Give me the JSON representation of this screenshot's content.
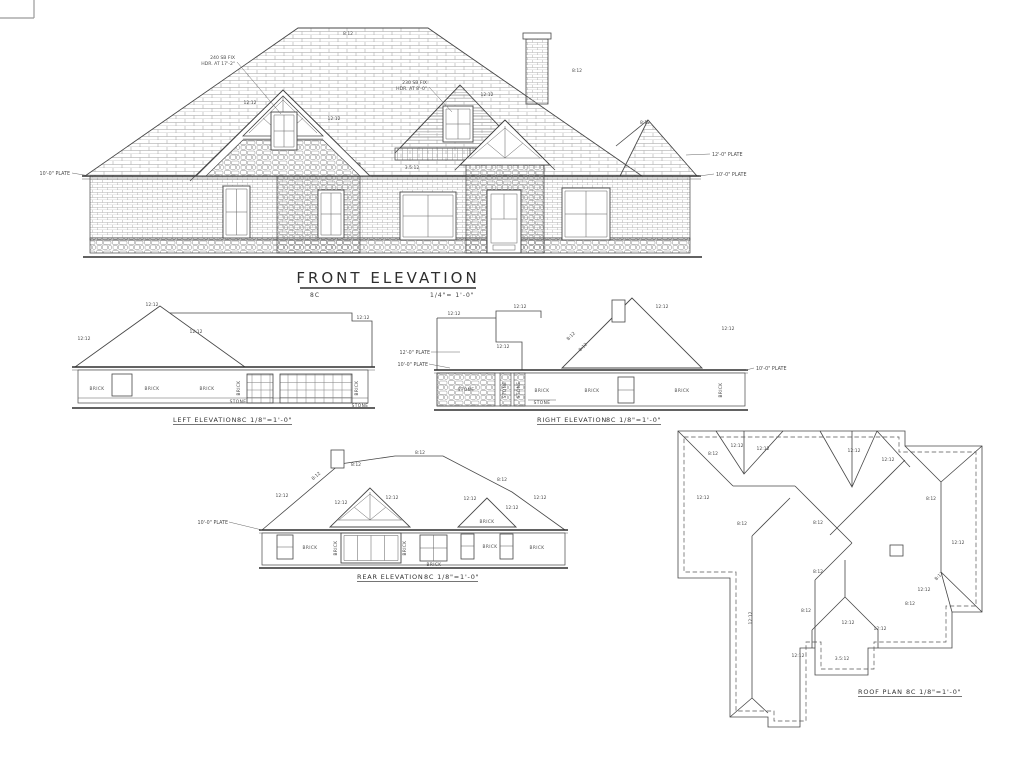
{
  "labels": {
    "brick": "BRICK",
    "stone": "STONE"
  },
  "pitches": {
    "p8": "8:12",
    "p12": "12:12",
    "p35": "3.5:12"
  },
  "plates": {
    "p10": "10'-0\" PLATE",
    "p12": "12'-0\" PLATE"
  },
  "front": {
    "title": "FRONT ELEVATION",
    "tag": "8C",
    "scale": "1/4\"= 1'-0\"",
    "note1_l1": "240 SB FIX",
    "note1_l2": "HDR. AT 17'-2\"",
    "note2_l1": "230 SB FIX",
    "note2_l2": "HDR. AT 8'-0\""
  },
  "left": {
    "title": "LEFT ELEVATION",
    "scale": "8C 1/8\"=1'-0\""
  },
  "right": {
    "title": "RIGHT ELEVATION",
    "scale": "8C 1/8\"=1'-0\""
  },
  "rear": {
    "title": "REAR ELEVATION",
    "scale": "8C 1/8\"=1'-0\""
  },
  "roof": {
    "title": "ROOF PLAN",
    "scale": "8C 1/8\"=1'-0\""
  }
}
